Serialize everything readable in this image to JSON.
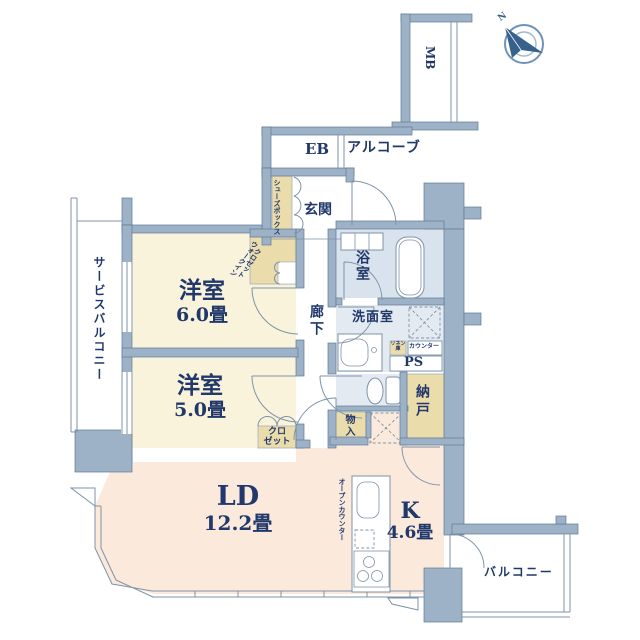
{
  "palette": {
    "wall": "#9DB2C7",
    "wall_line": "#5F7B95",
    "line": "#7E93A8",
    "ink": "#21386B",
    "cream": "#FAF3DB",
    "tan": "#EBDCAB",
    "pink": "#FBE9DC",
    "bath_floor": "#D9E3ED",
    "wet_floor": "#E4EAF1",
    "paper": "#FFFFFF",
    "compass": "#35618C"
  },
  "rooms": {
    "western6": {
      "label": "洋室",
      "size": "6.0畳"
    },
    "western5": {
      "label": "洋室",
      "size": "5.0畳"
    },
    "living_dining": {
      "label": "LD",
      "size": "12.2畳"
    },
    "kitchen": {
      "label": "K",
      "size": "4.6畳"
    },
    "entrance": {
      "label": "玄関"
    },
    "hallway": {
      "label": "廊下"
    },
    "bathroom": {
      "label": "浴室"
    },
    "washroom": {
      "label": "洗面室"
    },
    "storage": {
      "label": "納戸"
    },
    "storage_small": {
      "label": "物入"
    },
    "closet": {
      "line1": "クロ",
      "line2": "ゼット"
    },
    "walk_in_closet": {
      "line1": "ウォークイン",
      "line2": "クロゼット"
    },
    "shoe_box": {
      "label": "シューズボックス"
    },
    "linen": {
      "line1": "リネン",
      "line2": "庫"
    },
    "counter": {
      "label": "カウンター"
    },
    "pipe_space": {
      "label": "PS"
    },
    "meter_box": {
      "label": "MB"
    },
    "electrical_box": {
      "label": "EB"
    },
    "alcove": {
      "label": "アルコーブ"
    },
    "open_counter": {
      "label": "オープンカウンター"
    },
    "service_balcony": {
      "label": "サービスバルコニー"
    },
    "balcony": {
      "label": "バルコニー"
    }
  },
  "compass": {
    "label": "N"
  }
}
